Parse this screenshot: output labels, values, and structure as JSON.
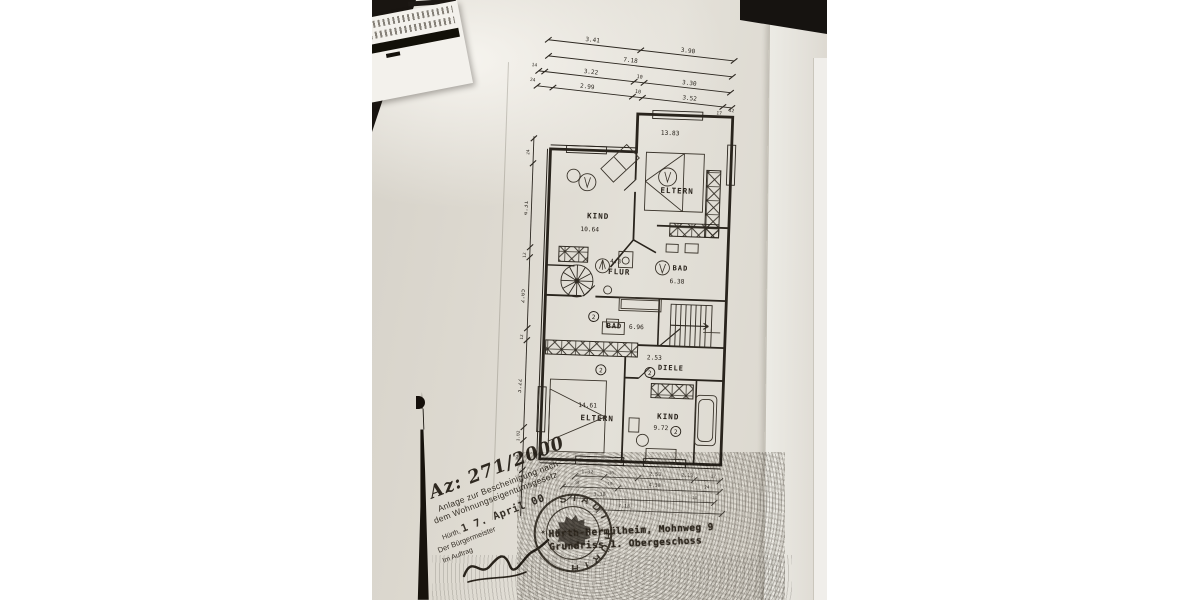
{
  "annotations": {
    "case_number": "Az: 271/2000",
    "anlage_line1": "Anlage zur Bescheinigung nach",
    "anlage_line2": "dem Wohnungseigentumsgesetz",
    "city_label": "Hürth,",
    "date_stamp": "1 7. April 00",
    "mayor_line": "Der Bürgermeister",
    "by_order_line": "Im Auftrag",
    "stamp_text": "STADT HÜRTH",
    "address_line1": "Hürth-Hermülheim, Mohnweg 9",
    "address_line2": "Grundriss 1. Obergeschoss"
  },
  "icons": {
    "stamp_star": "✶"
  },
  "plan": {
    "rooms": {
      "eltern_upper": {
        "label": "ELTERN",
        "area": "13.83"
      },
      "kind_upper": {
        "label": "KIND",
        "area": "10.64"
      },
      "flur": {
        "label": "FLUR",
        "area": "4.3"
      },
      "bad_upper": {
        "label": "BAD",
        "area": "6.38"
      },
      "bad_lower": {
        "label": "BAD",
        "area": "6.96",
        "unit_no": "2"
      },
      "diele": {
        "label": "DIELE",
        "area": "2.53",
        "unit_no": "2"
      },
      "eltern_lower": {
        "label": "ELTERN",
        "area": "14.61",
        "unit_no": "2"
      },
      "kind_lower": {
        "label": "KIND",
        "area": "9.72",
        "unit_no": "2"
      }
    },
    "dims": {
      "top_row1": [
        "3.41",
        "3.90"
      ],
      "top_row2": [
        "7.18"
      ],
      "top_row3": [
        "14",
        "3.22",
        "10",
        "3.30"
      ],
      "top_row4": [
        "24",
        "2.99",
        "10",
        "3.52",
        "17",
        "12"
      ],
      "left": [
        "24",
        "4.31",
        "12",
        "2.05",
        "12",
        "3.22",
        "1.02",
        "30"
      ],
      "bottom_row1": [
        "1.32",
        "30",
        "2.53",
        "2.13",
        "17"
      ],
      "bottom_row2": [
        "30",
        "10",
        "4.38",
        "24"
      ],
      "bottom_row3": [
        "3.38",
        "14"
      ],
      "bottom_row4": [
        "7.18"
      ]
    }
  }
}
